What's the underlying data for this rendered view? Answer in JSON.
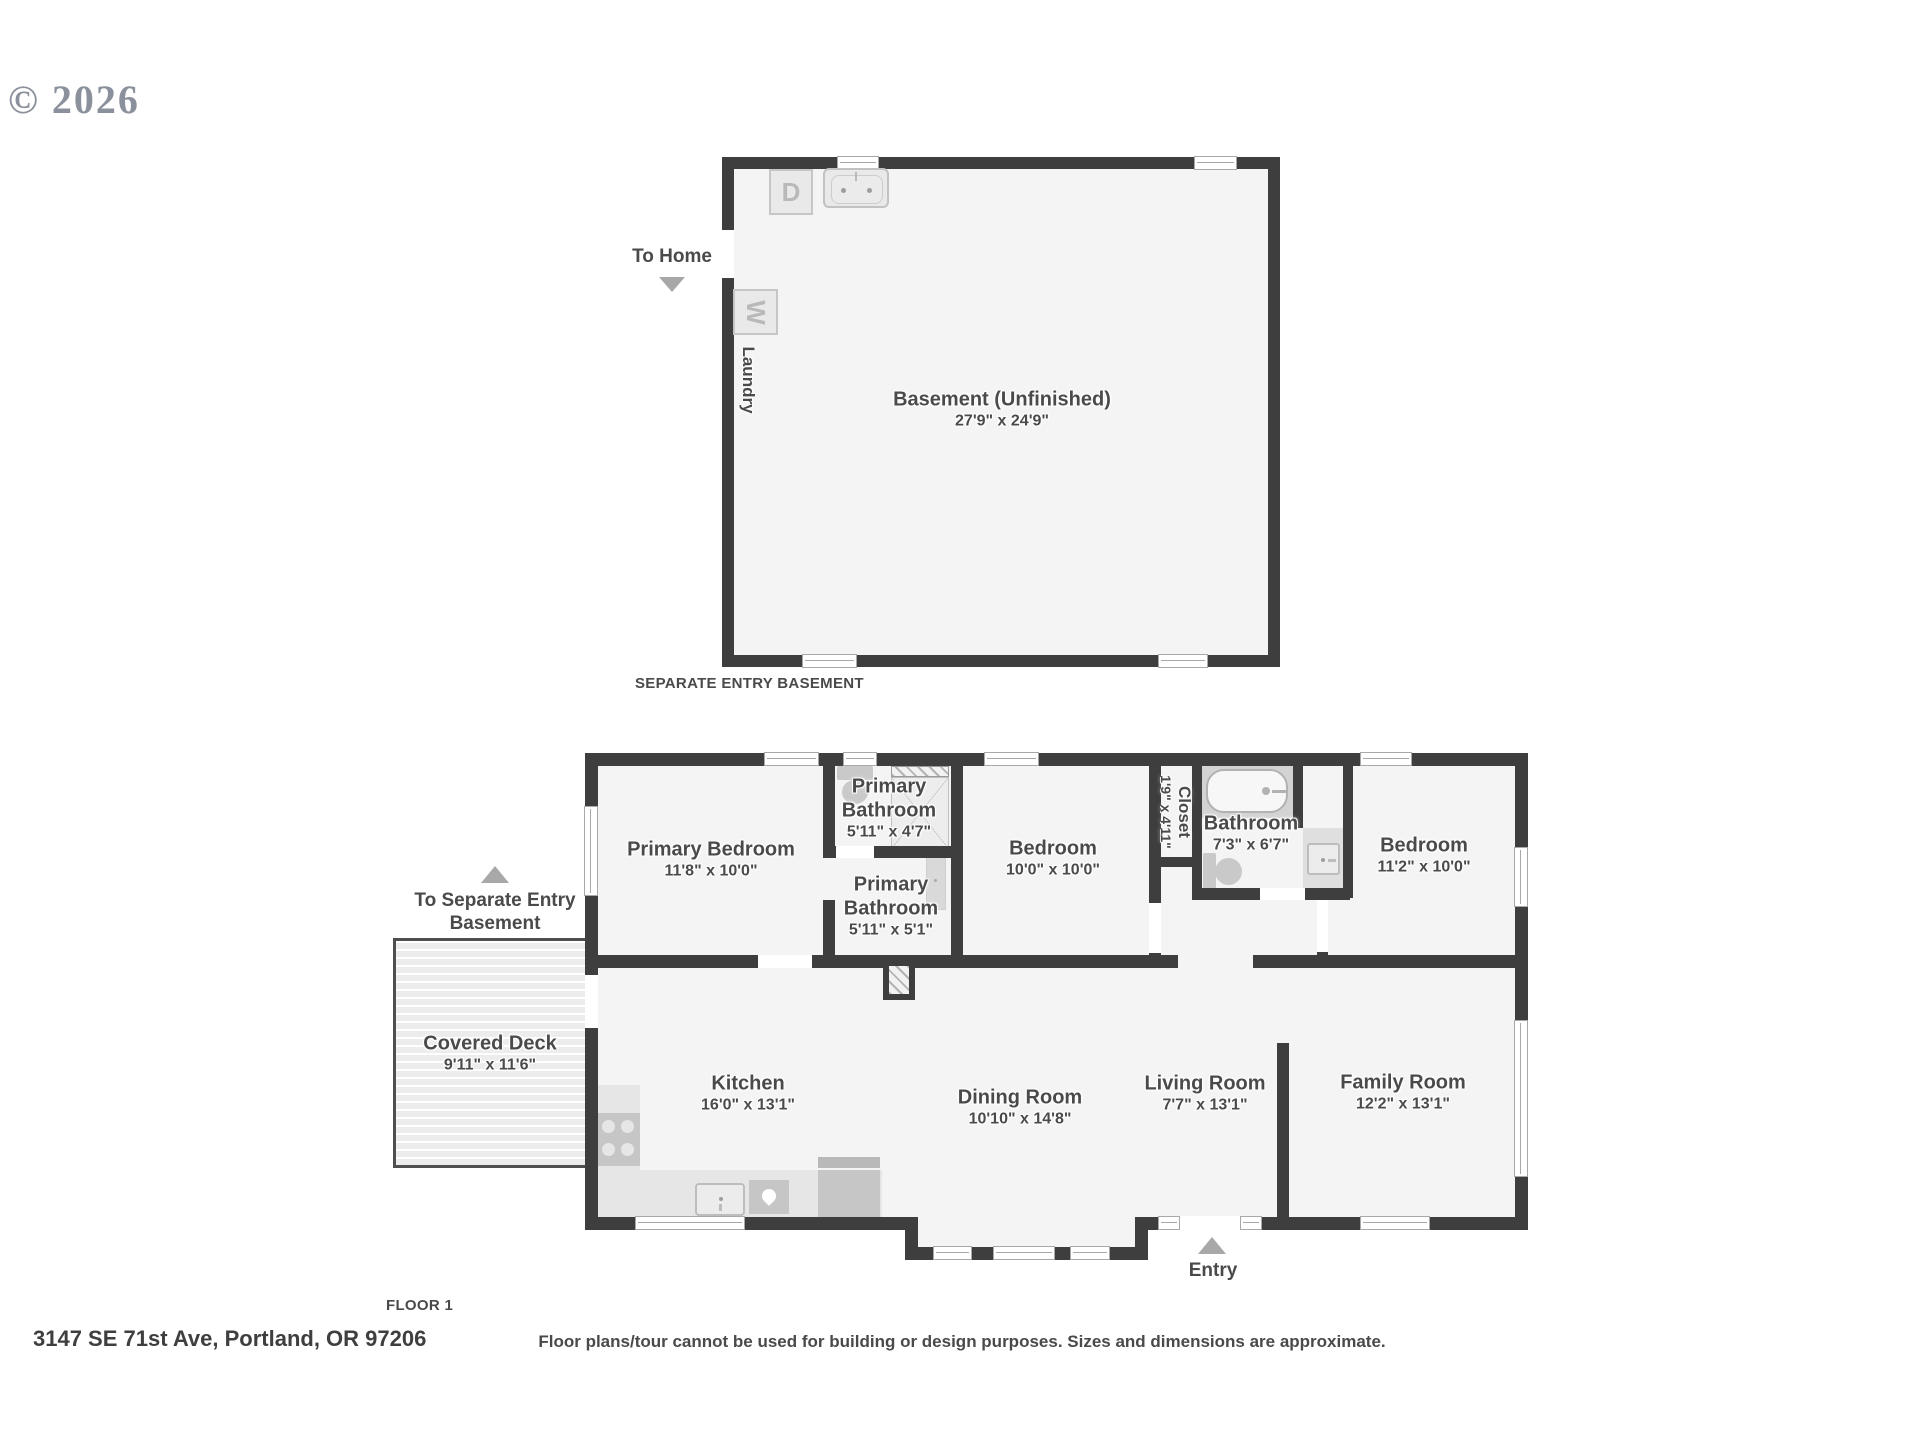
{
  "copyright": "© 2026",
  "basement": {
    "room_name": "Basement (Unfinished)",
    "room_dims": "27'9\" x 24'9\"",
    "laundry_label": "Laundry",
    "washer_label": "W",
    "dryer_label": "D",
    "to_home_label": "To Home",
    "caption": "SEPARATE ENTRY BASEMENT"
  },
  "floor1": {
    "caption": "FLOOR 1",
    "to_basement_label": "To Separate Entry Basement",
    "entry_label": "Entry",
    "rooms": {
      "primary_bedroom": {
        "name": "Primary Bedroom",
        "dims": "11'8\" x 10'0\""
      },
      "primary_bathroom_upper": {
        "name": "Primary Bathroom",
        "dims": "5'11\" x 4'7\""
      },
      "primary_bathroom_lower": {
        "name": "Primary Bathroom",
        "dims": "5'11\" x 5'1\""
      },
      "bedroom_middle": {
        "name": "Bedroom",
        "dims": "10'0\" x 10'0\""
      },
      "closet": {
        "name": "Closet",
        "dims": "1'9\" x 4'11\""
      },
      "bathroom": {
        "name": "Bathroom",
        "dims": "7'3\" x 6'7\""
      },
      "bedroom_right": {
        "name": "Bedroom",
        "dims": "11'2\" x 10'0\""
      },
      "covered_deck": {
        "name": "Covered Deck",
        "dims": "9'11\" x 11'6\""
      },
      "kitchen": {
        "name": "Kitchen",
        "dims": "16'0\" x 13'1\""
      },
      "dining_room": {
        "name": "Dining Room",
        "dims": "10'10\" x 14'8\""
      },
      "living_room": {
        "name": "Living Room",
        "dims": "7'7\" x 13'1\""
      },
      "family_room": {
        "name": "Family Room",
        "dims": "12'2\" x 13'1\""
      }
    }
  },
  "footer": {
    "address": "3147 SE 71st Ave, Portland, OR 97206",
    "disclaimer": "Floor plans/tour cannot be used for building or design purposes. Sizes and dimensions are approximate."
  },
  "colors": {
    "wall": "#3e3e3e",
    "floor": "#f4f4f4",
    "fixture": "#c9c9c9",
    "arrow": "#a8a8a8",
    "label_text": "#4a4a4a"
  }
}
